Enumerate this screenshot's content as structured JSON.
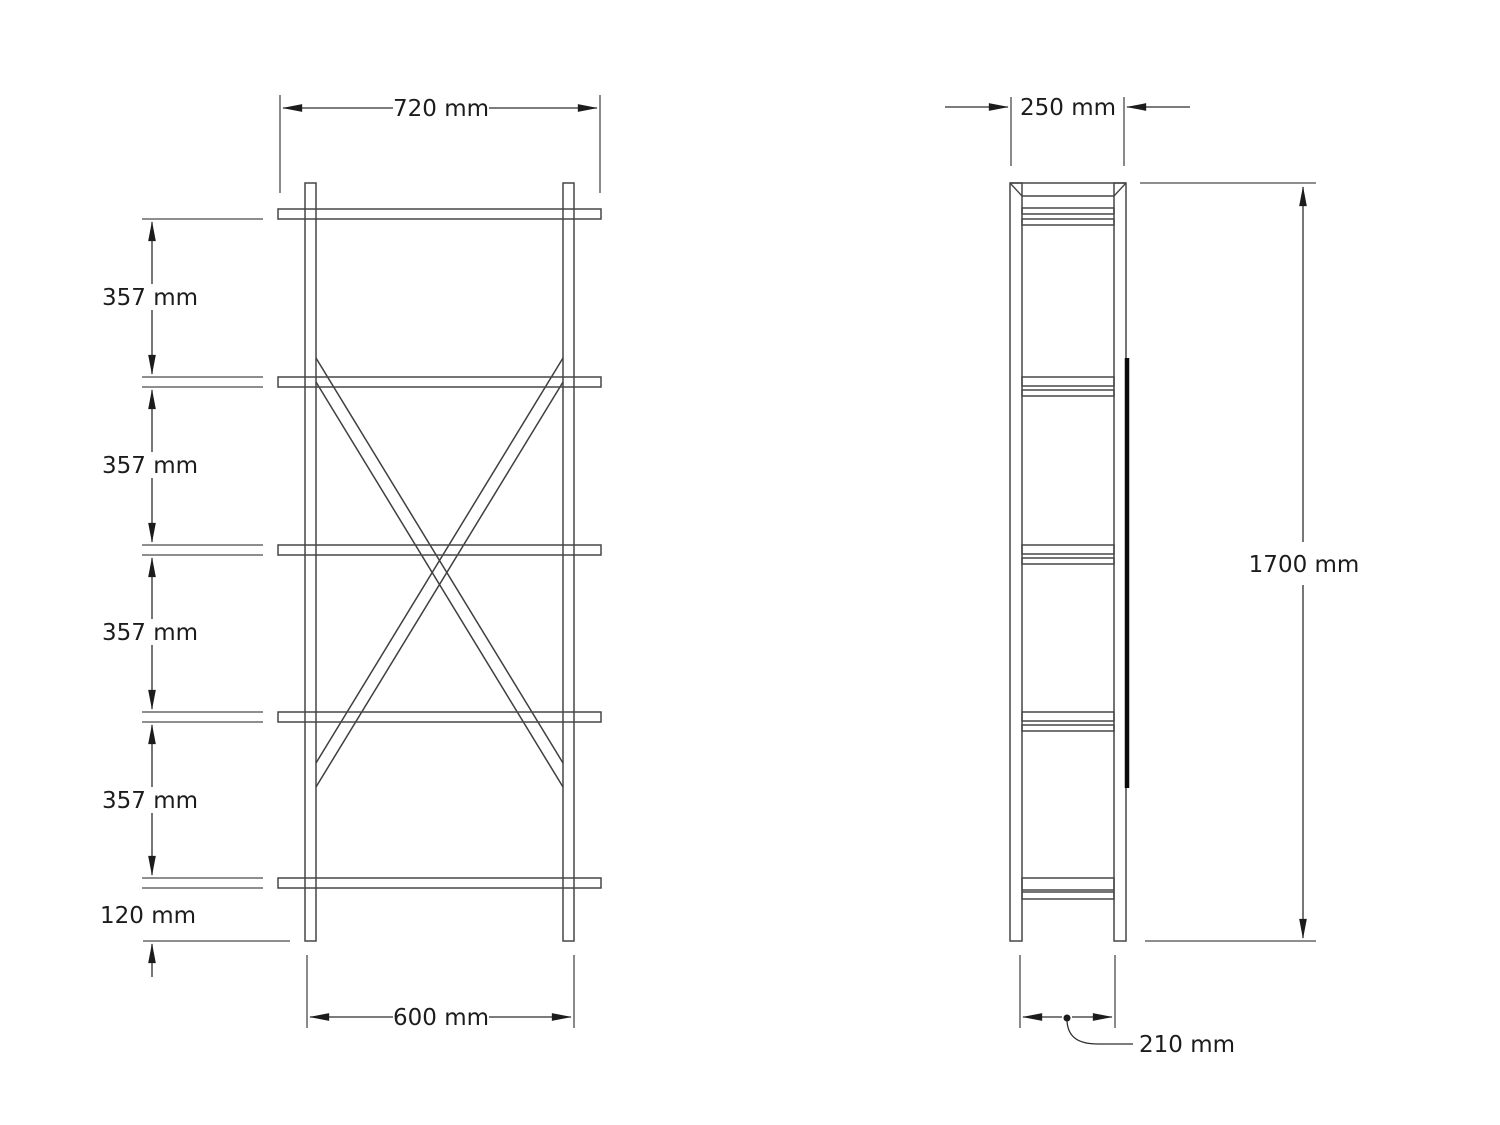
{
  "drawing": {
    "type": "technical-orthographic-drawing",
    "subject": "five-shelf open bookcase, front view and side view",
    "units": "mm",
    "colors": {
      "background": "#ffffff",
      "line": "#474747",
      "dimension_line": "#2e2e2e",
      "text": "#1c1c1c",
      "back_brace_bar": "#0a0a0a"
    },
    "dims": {
      "front_width_top": "720 mm",
      "front_width_bottom": "600 mm",
      "front_spacings": [
        "357 mm",
        "357 mm",
        "357 mm",
        "357 mm"
      ],
      "front_bottom_gap": "120 mm",
      "side_width_top": "250 mm",
      "side_height": "1700 mm",
      "side_width_bottom": "210 mm"
    }
  }
}
